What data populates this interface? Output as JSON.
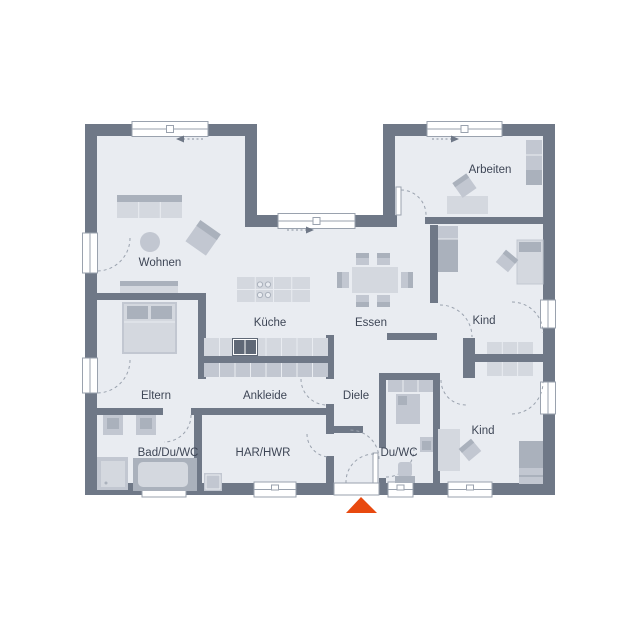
{
  "floorplan": {
    "rooms": [
      {
        "id": "wohnen",
        "label": "Wohnen"
      },
      {
        "id": "kueche",
        "label": "Küche"
      },
      {
        "id": "essen",
        "label": "Essen"
      },
      {
        "id": "arbeiten",
        "label": "Arbeiten"
      },
      {
        "id": "kind-top",
        "label": "Kind"
      },
      {
        "id": "eltern",
        "label": "Eltern"
      },
      {
        "id": "ankleide",
        "label": "Ankleide"
      },
      {
        "id": "diele",
        "label": "Diele"
      },
      {
        "id": "kind-bottom",
        "label": "Kind"
      },
      {
        "id": "bad",
        "label": "Bad/Du/WC"
      },
      {
        "id": "har",
        "label": "HAR/HWR"
      },
      {
        "id": "du-wc",
        "label": "Du/WC"
      }
    ],
    "entrance_marker": "triangle-up",
    "colors": {
      "wall": "#6f7887",
      "floor": "#e9ecf1",
      "furniture_light": "#d4d8df",
      "furniture_mid": "#c2c7d1",
      "furniture_dark": "#aab1bc",
      "appliance_dark": "#5f6876",
      "frame": "#9aa2ae",
      "label_text": "#3e4656",
      "accent_orange": "#e8490f",
      "window_fill": "#ffffff"
    }
  }
}
